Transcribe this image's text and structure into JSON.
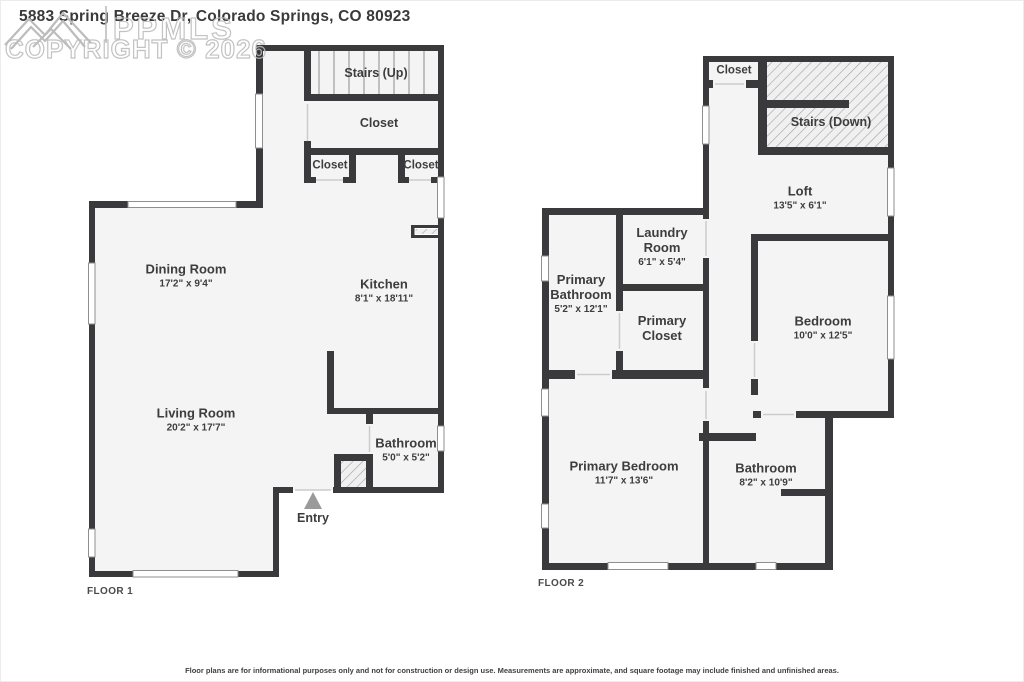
{
  "header": {
    "title": "5883 Spring Breeze Dr, Colorado Springs, CO 80923",
    "watermark_brand": "PPMLS",
    "watermark_copyright": "COPYRIGHT © 2026"
  },
  "floor1": {
    "label": "FLOOR 1",
    "stairs": "Stairs (Up)",
    "closet_top": "Closet",
    "closet_left": "Closet",
    "closet_right": "Closet",
    "dining": {
      "name": "Dining Room",
      "dims": "17'2\" x 9'4\""
    },
    "kitchen": {
      "name": "Kitchen",
      "dims": "8'1\" x 18'11\""
    },
    "living": {
      "name": "Living Room",
      "dims": "20'2\" x 17'7\""
    },
    "bathroom": {
      "name": "Bathroom",
      "dims": "5'0\" x 5'2\""
    },
    "entry": "Entry"
  },
  "floor2": {
    "label": "FLOOR 2",
    "closet": "Closet",
    "stairs": "Stairs (Down)",
    "loft": {
      "name": "Loft",
      "dims": "13'5\" x 6'1\""
    },
    "laundry": {
      "name": "Laundry Room",
      "dims": "6'1\" x 5'4\""
    },
    "primary_bathroom": {
      "name": "Primary Bathroom",
      "dims": "5'2\" x 12'1\""
    },
    "primary_closet": {
      "name": "Primary Closet"
    },
    "bedroom": {
      "name": "Bedroom",
      "dims": "10'0\" x 12'5\""
    },
    "primary_bedroom": {
      "name": "Primary Bedroom",
      "dims": "11'7\" x 13'6\""
    },
    "bathroom": {
      "name": "Bathroom",
      "dims": "8'2\" x 10'9\""
    }
  },
  "footer": {
    "disclaimer": "Floor plans are for informational purposes only and not for construction or design use. Measurements are approximate, and square footage may include finished and unfinished areas."
  },
  "colors": {
    "wall": "#3a3a3c",
    "floor": "#f4f4f4",
    "label_text": "#3d3d3d",
    "watermark": "#bcbcbc",
    "entry_arrow": "#9a9a9a"
  }
}
